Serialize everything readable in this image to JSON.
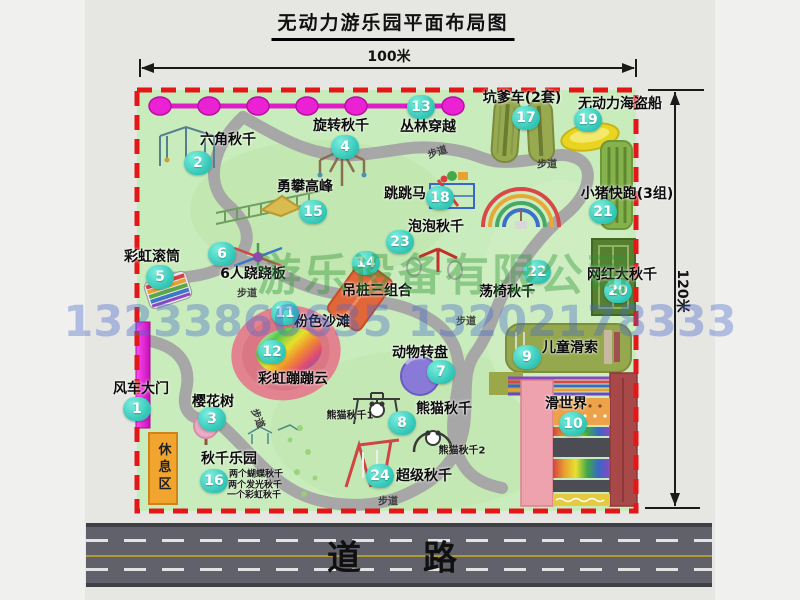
{
  "title": "无动力游乐园平面布局图",
  "dimensions": {
    "width_label": "100米",
    "height_label": "120米"
  },
  "road": {
    "label": "道　路"
  },
  "watermark": {
    "company": "游乐设备有限公司",
    "phone": "13233860635 13202178333"
  },
  "colors": {
    "map_green": "#c9ecbc",
    "border_red": "#e31717",
    "path_gray": "#a7a7a7",
    "badge_teal": "#2fc4b4",
    "zipline_magenta": "#e01bc8",
    "gate_magenta": "#d816c6",
    "rest_orange": "#f2a52e",
    "road_gray": "#61616b"
  },
  "park": {
    "rest_area_label": "休息区",
    "trail_text": "步道",
    "trail_labels": [
      {
        "x": 247,
        "y": 292,
        "rot": 0
      },
      {
        "x": 437,
        "y": 151,
        "rot": -18
      },
      {
        "x": 547,
        "y": 163,
        "rot": 0
      },
      {
        "x": 259,
        "y": 418,
        "rot": 68
      },
      {
        "x": 388,
        "y": 500,
        "rot": 0
      },
      {
        "x": 466,
        "y": 320,
        "rot": 0
      }
    ],
    "attractions": [
      {
        "num": 1,
        "label": "风车大门",
        "badge": {
          "x": 137,
          "y": 409
        },
        "label_pos": {
          "x": 141,
          "y": 388
        }
      },
      {
        "num": 2,
        "label": "六角秋千",
        "badge": {
          "x": 198,
          "y": 163
        },
        "label_pos": {
          "x": 228,
          "y": 139
        }
      },
      {
        "num": 3,
        "label": "樱花树",
        "badge": {
          "x": 212,
          "y": 419
        },
        "label_pos": {
          "x": 213,
          "y": 401
        }
      },
      {
        "num": 4,
        "label": "旋转秋千",
        "badge": {
          "x": 345,
          "y": 147
        },
        "label_pos": {
          "x": 341,
          "y": 125
        }
      },
      {
        "num": 5,
        "label": "彩虹滚筒",
        "badge": {
          "x": 160,
          "y": 277
        },
        "label_pos": {
          "x": 152,
          "y": 256
        }
      },
      {
        "num": 6,
        "label": "6人跷跷板",
        "badge": {
          "x": 222,
          "y": 254
        },
        "label_pos": {
          "x": 253,
          "y": 273
        }
      },
      {
        "num": 7,
        "label": "动物转盘",
        "badge": {
          "x": 441,
          "y": 372
        },
        "label_pos": {
          "x": 420,
          "y": 352
        }
      },
      {
        "num": 8,
        "label": "熊猫秋千",
        "badge": {
          "x": 402,
          "y": 423
        },
        "label_pos": {
          "x": 444,
          "y": 408
        }
      },
      {
        "num": 9,
        "label": "儿童滑索",
        "badge": {
          "x": 527,
          "y": 357
        },
        "label_pos": {
          "x": 570,
          "y": 347
        }
      },
      {
        "num": 10,
        "label": "滑世界",
        "badge": {
          "x": 573,
          "y": 424
        },
        "label_pos": {
          "x": 566,
          "y": 403
        }
      },
      {
        "num": 11,
        "label": "粉色沙滩",
        "badge": {
          "x": 285,
          "y": 313
        },
        "label_pos": {
          "x": 322,
          "y": 321
        }
      },
      {
        "num": 12,
        "label": "彩虹蹦蹦云",
        "badge": {
          "x": 272,
          "y": 352
        },
        "label_pos": {
          "x": 293,
          "y": 378
        }
      },
      {
        "num": 13,
        "label": "丛林穿越",
        "badge": {
          "x": 421,
          "y": 107
        },
        "label_pos": {
          "x": 428,
          "y": 126
        }
      },
      {
        "num": 14,
        "label": "吊桩三组合",
        "badge": {
          "x": 366,
          "y": 263
        },
        "label_pos": {
          "x": 377,
          "y": 290
        }
      },
      {
        "num": 15,
        "label": "勇攀高峰",
        "badge": {
          "x": 313,
          "y": 212
        },
        "label_pos": {
          "x": 305,
          "y": 186
        }
      },
      {
        "num": 16,
        "label": "秋千乐园",
        "badge": {
          "x": 214,
          "y": 481
        },
        "label_pos": {
          "x": 229,
          "y": 458
        }
      },
      {
        "num": 17,
        "label": "坑爹车(2套)",
        "badge": {
          "x": 526,
          "y": 118
        },
        "label_pos": {
          "x": 522,
          "y": 97
        }
      },
      {
        "num": 18,
        "label": "跳跳马",
        "badge": {
          "x": 440,
          "y": 198
        },
        "label_pos": {
          "x": 405,
          "y": 193
        }
      },
      {
        "num": 19,
        "label": "无动力海盗船",
        "badge": {
          "x": 588,
          "y": 120
        },
        "label_pos": {
          "x": 620,
          "y": 103
        }
      },
      {
        "num": 20,
        "label": "网红大秋千",
        "badge": {
          "x": 618,
          "y": 291
        },
        "label_pos": {
          "x": 622,
          "y": 274
        }
      },
      {
        "num": 21,
        "label": "小猪快跑(3组)",
        "badge": {
          "x": 603,
          "y": 212
        },
        "label_pos": {
          "x": 627,
          "y": 193
        }
      },
      {
        "num": 22,
        "label": "荡椅秋千",
        "badge": {
          "x": 537,
          "y": 272
        },
        "label_pos": {
          "x": 507,
          "y": 291
        }
      },
      {
        "num": 23,
        "label": "泡泡秋千",
        "badge": {
          "x": 400,
          "y": 242
        },
        "label_pos": {
          "x": 436,
          "y": 226
        }
      },
      {
        "num": 24,
        "label": "超级秋千",
        "badge": {
          "x": 380,
          "y": 476
        },
        "label_pos": {
          "x": 424,
          "y": 475
        }
      }
    ],
    "sub_labels": [
      {
        "text": "熊猫秋千1",
        "x": 350,
        "y": 414,
        "size": 10
      },
      {
        "text": "熊猫秋千2",
        "x": 462,
        "y": 449,
        "size": 10
      },
      {
        "text": "两个蝴蝶秋千",
        "x": 256,
        "y": 473,
        "size": 9
      },
      {
        "text": "两个发光秋千",
        "x": 255,
        "y": 484,
        "size": 9
      },
      {
        "text": "一个彩虹秋千",
        "x": 254,
        "y": 494,
        "size": 9
      }
    ]
  }
}
